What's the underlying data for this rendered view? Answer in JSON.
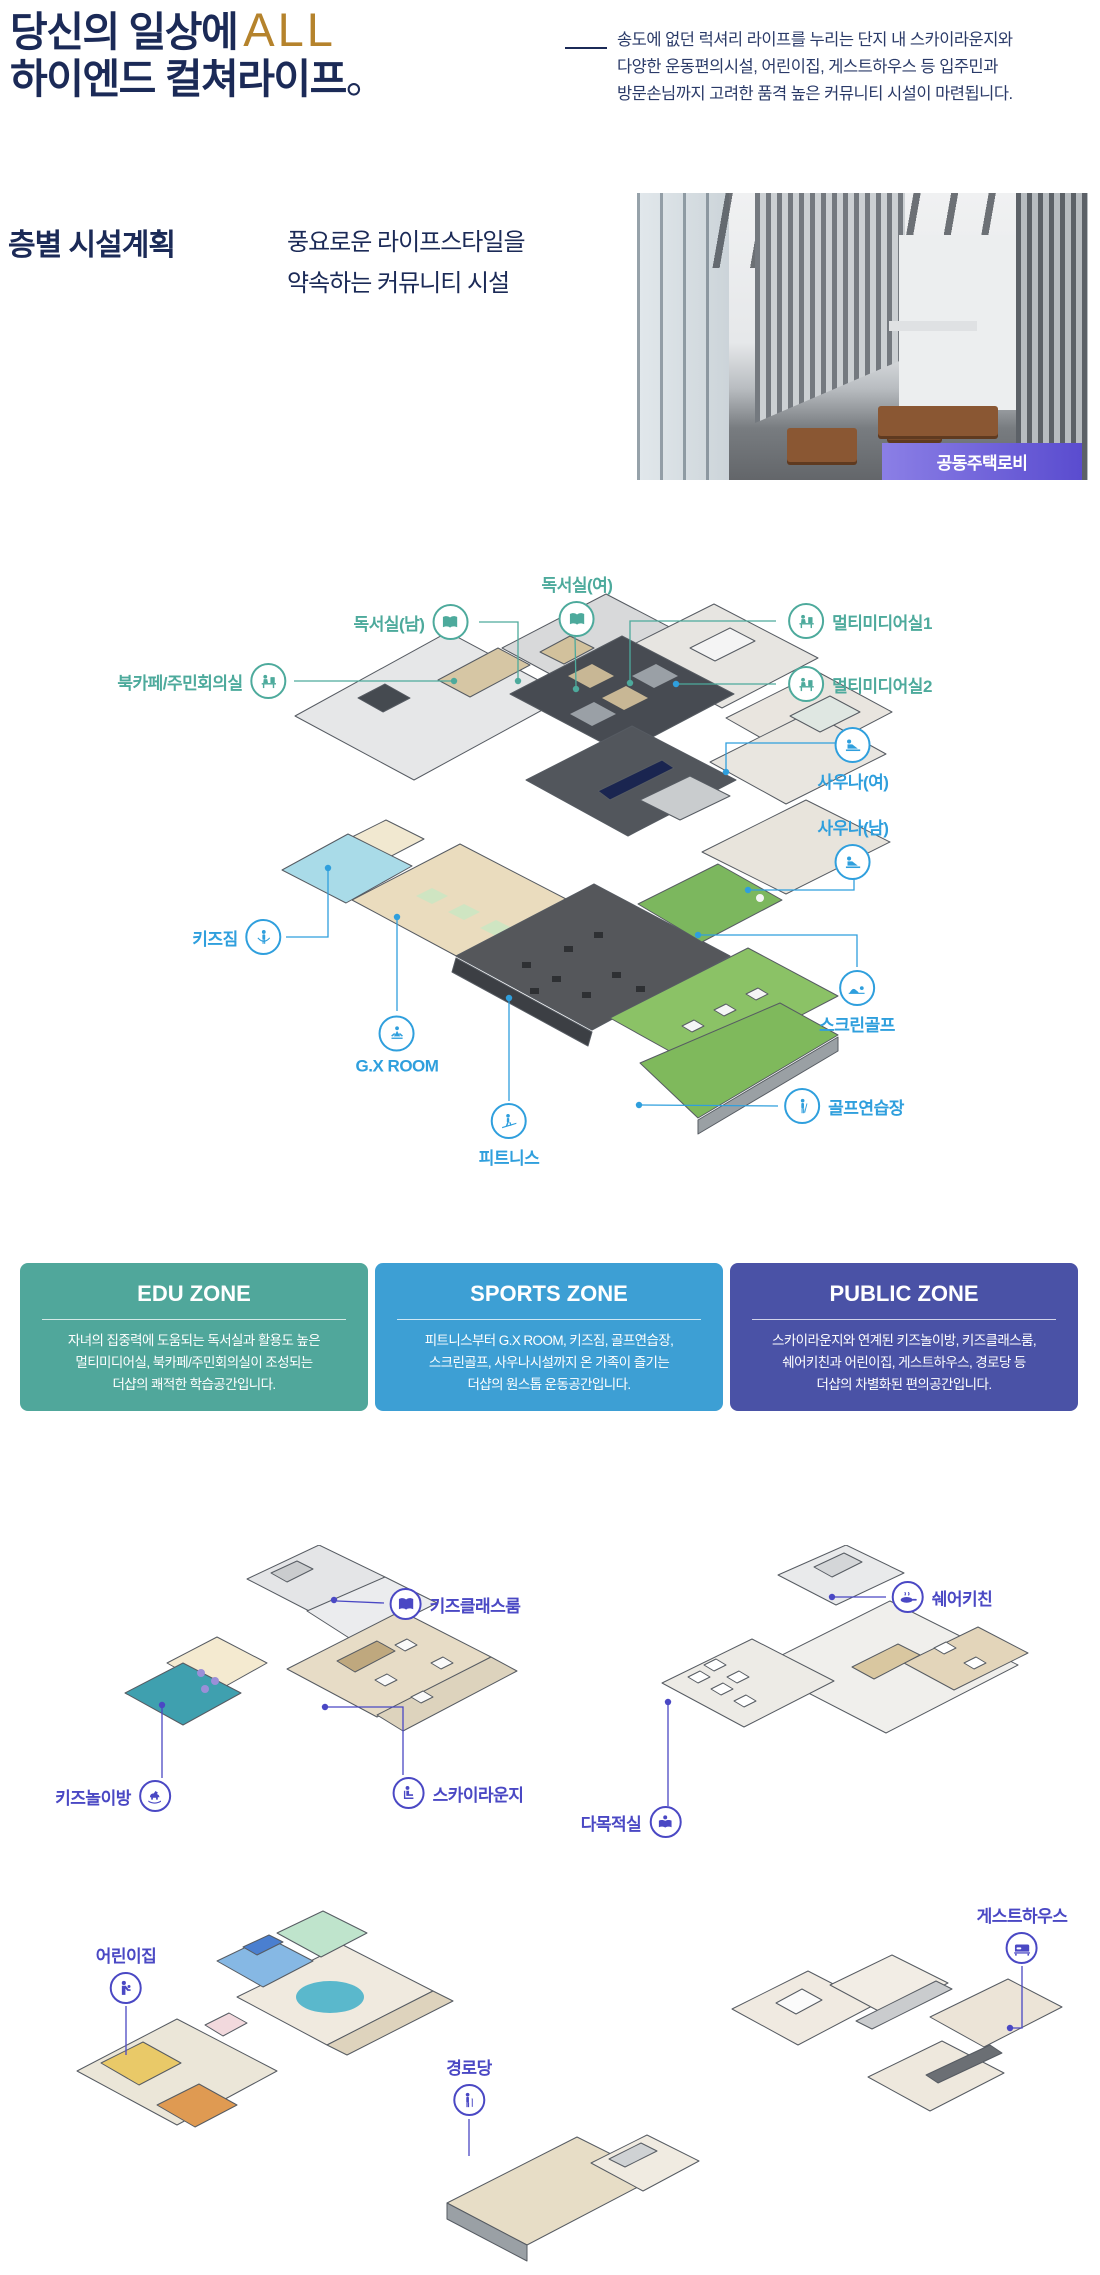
{
  "colors": {
    "navy": "#1b2a57",
    "accent": "#b5832c",
    "edu_label": "#4daa9c",
    "sports_label": "#2f9fdd",
    "public_label": "#4a48c4",
    "badge_purple": "#5a4ccf"
  },
  "header": {
    "title_prefix": "당신의 일상에",
    "title_accent": "ALL",
    "title_line2": "하이엔드 컬쳐라이프",
    "title_period": "。",
    "intro_lines": [
      "송도에 없던 럭셔리 라이프를 누리는 단지 내 스카이라운지와",
      "다양한 운동편의시설, 어린이집, 게스트하우스 등 입주민과",
      "방문손님까지 고려한 품격 높은 커뮤니티 시설이 마련됩니다."
    ]
  },
  "section": {
    "heading": "층별 시설계획",
    "sub_lines": [
      "풍요로운 라이프스타일을",
      "약속하는 커뮤니티 시설"
    ],
    "photo_caption": "공동주택로비"
  },
  "plan_labels": {
    "reading_f": "독서실(여)",
    "reading_m": "독서실(남)",
    "bookcafe": "북카페/주민회의실",
    "multimedia1": "멀티미디어실1",
    "multimedia2": "멀티미디어실2",
    "sauna_f": "사우나(여)",
    "sauna_m": "사우나(남)",
    "screen_golf": "스크린골프",
    "golf_range": "골프연습장",
    "kids_gym": "키즈짐",
    "gx_room": "G.X ROOM",
    "fitness": "피트니스"
  },
  "sub_labels": {
    "kids_class": "키즈클래스룸",
    "kids_play": "키즈놀이방",
    "sky_lounge": "스카이라운지",
    "share_kitchen": "쉐어키친",
    "multi_room": "다목적실",
    "daycare": "어린이집",
    "senior": "경로당",
    "guesthouse": "게스트하우스"
  },
  "zones": [
    {
      "title": "EDU ZONE",
      "color": "#50a79b",
      "lines": [
        "자녀의 집중력에 도움되는 독서실과 활용도 높은",
        "멀티미디어실, 북카페/주민회의실이 조성되는",
        "더샵의 쾌적한 학습공간입니다."
      ]
    },
    {
      "title": "SPORTS ZONE",
      "color": "#3d9fd4",
      "lines": [
        "피트니스부터 G.X ROOM, 키즈짐, 골프연습장,",
        "스크린골프, 사우나시설까지 온 가족이 즐기는",
        "더샵의 원스톱 운동공간입니다."
      ]
    },
    {
      "title": "PUBLIC ZONE",
      "color": "#4a52a6",
      "lines": [
        "스카이라운지와 연계된 키즈놀이방, 키즈클래스룸,",
        "쉐어키친과 어린이집, 게스트하우스, 경로당 등",
        "더샵의 차별화된 편의공간입니다."
      ]
    }
  ]
}
